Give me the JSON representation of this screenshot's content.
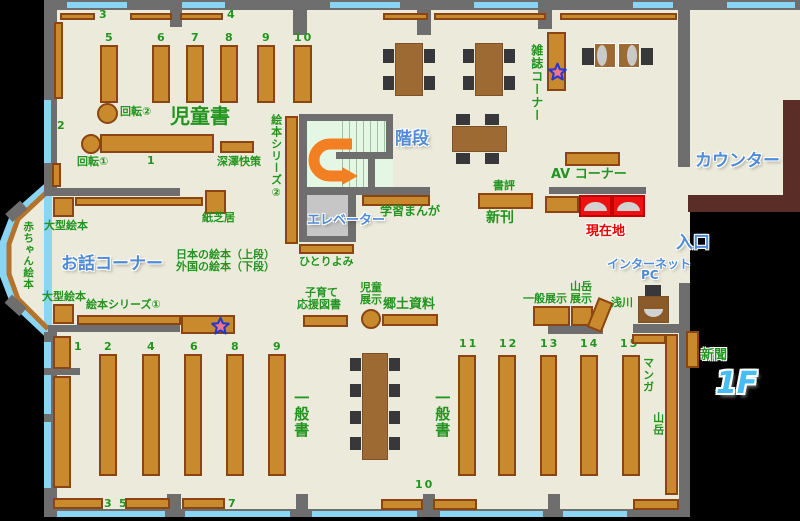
{
  "floor_tag": "1F",
  "areas": {
    "children": "児童書",
    "story_corner": "お話コーナー",
    "magazine_corner": "雑誌コーナー",
    "av_corner": "AV コーナー",
    "counter": "カウンター",
    "entrance": "入口",
    "stairs": "階段",
    "elevator": "エレベーター",
    "internet_pc_line1": "インターネット",
    "internet_pc_line2": "PC",
    "general_books_left": "一般書",
    "general_books_right": "一般書"
  },
  "shelf_labels": {
    "rotating1": "回転①",
    "rotating2": "回転②",
    "fukazawa": "深澤快策",
    "picture_series1": "絵本シリーズ①",
    "picture_series2": "絵本シリーズ②",
    "kamishibai": "紙芝居",
    "large_picture_top": "大型絵本",
    "large_picture_bottom": "大型絵本",
    "baby_books": "赤ちゃん絵本",
    "japanese_books": "日本の絵本（上段）",
    "foreign_books": "外国の絵本（下段）",
    "hitoriyomi": "ひとりよみ",
    "parenting_line1": "子育て",
    "parenting_line2": "応援図書",
    "child_exhibit_line1": "児童",
    "child_exhibit_line2": "展示",
    "local_materials": "郷土資料",
    "reviews": "書評",
    "new_books": "新刊",
    "current_location": "現在地",
    "study_manga": "学習まんが",
    "general_exhibit": "一般展示",
    "mountain_exhibit_line1": "山岳",
    "mountain_exhibit_line2": "展示",
    "asakawa": "浅川",
    "newspaper": "新聞",
    "manga": "マンガ",
    "mountain": "山岳"
  },
  "nums": {
    "top_row": [
      "3",
      "4"
    ],
    "children_vertical": [
      "5",
      "6",
      "7",
      "8",
      "9",
      "10"
    ],
    "children_left": "2",
    "children_shelf1": "1",
    "general_left": [
      "1",
      "2",
      "4",
      "6",
      "8",
      "9"
    ],
    "general_bottom": [
      "3",
      "5",
      "7"
    ],
    "bottom_center": "10",
    "general_right": [
      "11",
      "12",
      "13",
      "14",
      "15"
    ]
  },
  "colors": {
    "floor": "#ecebdb",
    "wall": "#6e6e6e",
    "window": "#8ad4f4",
    "shelf": "#c9892d",
    "shelf_border": "#8a4513",
    "counter": "#5a2e26",
    "label_green": "#21951f",
    "label_blue": "#4f8bd6",
    "label_red": "#e60000",
    "highlight_red": "#ee1111",
    "arrow_orange": "#f28022",
    "stairs_fill": "#e4f6e4",
    "elevator_fill": "#c6c6c6"
  }
}
